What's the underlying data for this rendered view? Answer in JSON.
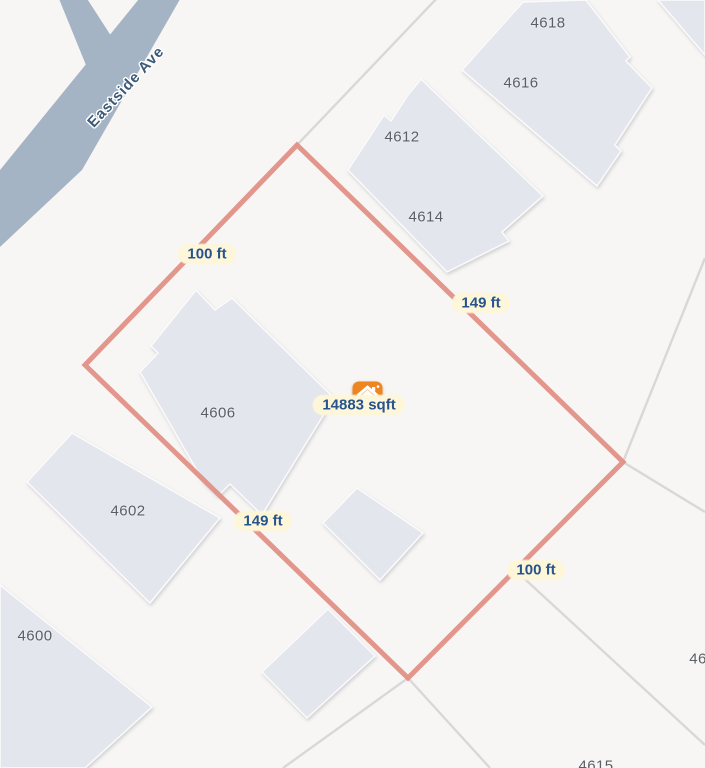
{
  "street": {
    "name": "Eastside Ave"
  },
  "lot": {
    "area": "14883 sqft",
    "sides": [
      {
        "label": "100 ft"
      },
      {
        "label": "149 ft"
      },
      {
        "label": "149 ft"
      },
      {
        "label": "100 ft"
      }
    ]
  },
  "parcels": [
    {
      "number": "4618"
    },
    {
      "number": "4616"
    },
    {
      "number": "4612"
    },
    {
      "number": "4614"
    },
    {
      "number": "4606"
    },
    {
      "number": "4602"
    },
    {
      "number": "4600"
    },
    {
      "number": "46"
    },
    {
      "number": "4615"
    }
  ],
  "marker": {
    "icon": "home-icon"
  },
  "colors": {
    "background": "#f8f6f4",
    "road": "#a5b4c4",
    "building": "#e4e6ed",
    "parcel_line": "#d8d6d4",
    "lot_outline": "#e18d81",
    "label_bg": "#fdf6d8",
    "label_text": "#27548e",
    "house_number": "#5a5e66",
    "street_text": "#3c5a77",
    "marker": "#ef8521"
  }
}
